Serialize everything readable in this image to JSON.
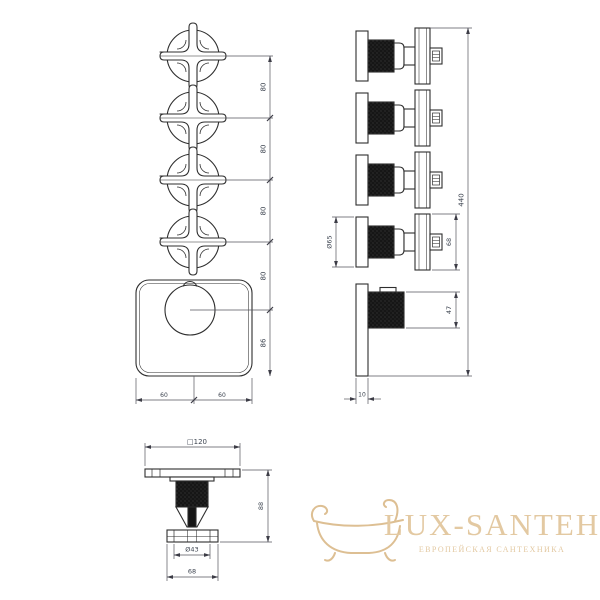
{
  "drawing": {
    "front": {
      "gap_labels": [
        "80",
        "80",
        "80",
        "80",
        "86"
      ],
      "half_width_labels": [
        "60",
        "60"
      ]
    },
    "side": {
      "total_height": "440",
      "escutcheon_diameter": "Ø65",
      "handle_height": "68",
      "cartridge_depth": "47",
      "plate_thickness": "10"
    },
    "bottom": {
      "plate_size": "□120",
      "total_depth": "88",
      "knob_diameter": "Ø43",
      "handle_width": "68"
    }
  },
  "logo": {
    "brand": "LUX-SANTEH",
    "tagline": "ЕВРОПЕЙСКАЯ САНТЕХНИКА"
  },
  "colors": {
    "line": "#2e2e2e",
    "dimension": "#3c3c46",
    "logo_text": "#e3c9a2",
    "logo_icon": "#ddbf93"
  }
}
